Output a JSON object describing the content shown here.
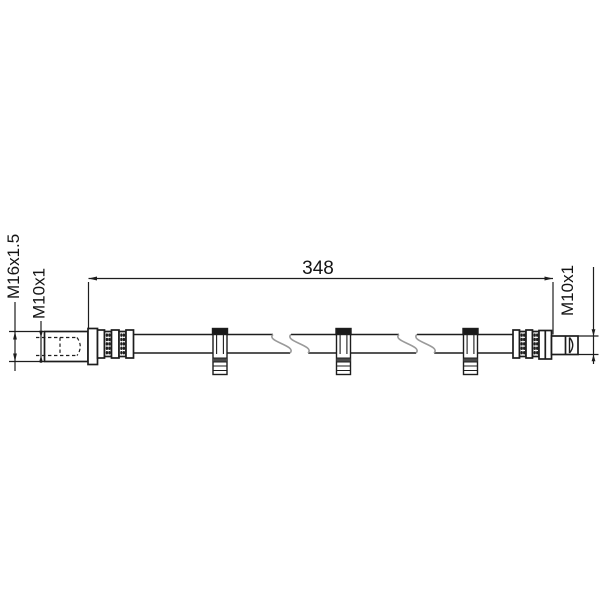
{
  "drawing": {
    "labels": {
      "hose_length": "348",
      "left_outer_thread": "M16x1.5",
      "left_inner_thread": "M10x1",
      "right_thread": "M10x1"
    },
    "colors": {
      "background": "#ffffff",
      "line": "#1d1d1d",
      "break_line": "#9a9a9a",
      "clip_cap_fill": "#1a1a1a",
      "clip_slat_fill": "#4a4a4a"
    }
  }
}
